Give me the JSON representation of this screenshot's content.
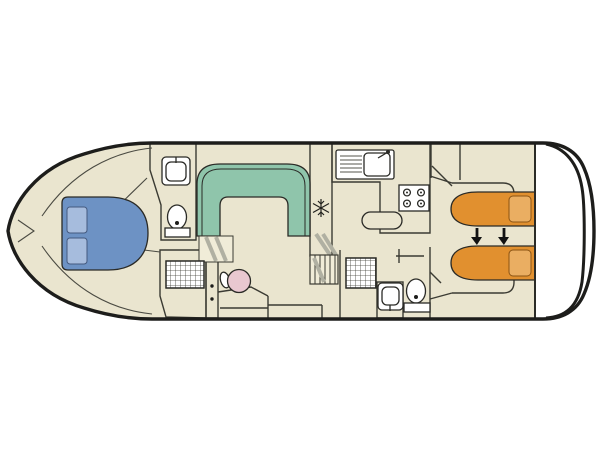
{
  "diagram": {
    "type": "boat-deck-plan",
    "title": "Canal cruiser interior deck plan (no visible text labels)"
  },
  "colors": {
    "background": "#ffffff",
    "hull_stroke": "#1d1d1b",
    "floor_beige": "#eae5cf",
    "room_gray": "#d2d2c4",
    "counter_gray": "#cbcbbd",
    "wall_stroke": "#3b3b33",
    "dinette_green": "#8fc5ab",
    "bed_blue": "#6d92c4",
    "pillow_blue": "#a6bcdd",
    "bed_orange": "#e1902f",
    "pillow_orange": "#eaae62",
    "wheel_pink": "#e9c8d0",
    "fixture_white": "#ffffff",
    "stair_shade": "#b0b0a2",
    "arrow_black": "#121212"
  },
  "rooms": [
    {
      "name": "bow-cabin"
    },
    {
      "name": "bow-bathroom"
    },
    {
      "name": "bow-shower-room"
    },
    {
      "name": "saloon-dinette"
    },
    {
      "name": "helm-station"
    },
    {
      "name": "galley"
    },
    {
      "name": "aft-bathroom"
    },
    {
      "name": "aft-cabin"
    },
    {
      "name": "stern-deck"
    }
  ],
  "fixtures": [
    {
      "name": "bow-double-bed",
      "color_key": "bed_blue",
      "pillows": 2
    },
    {
      "name": "bow-washbasin"
    },
    {
      "name": "bow-toilet"
    },
    {
      "name": "bow-shower"
    },
    {
      "name": "dinette-u-sofa",
      "color_key": "dinette_green"
    },
    {
      "name": "forward-companionway-steps"
    },
    {
      "name": "helm-steering-wheel",
      "color_key": "wheel_pink"
    },
    {
      "name": "helm-seat"
    },
    {
      "name": "fridge-snowflake-icon"
    },
    {
      "name": "galley-sink-with-drainer"
    },
    {
      "name": "galley-stove-4-burner"
    },
    {
      "name": "galley-counter-peninsula"
    },
    {
      "name": "midship-steps"
    },
    {
      "name": "midship-shower"
    },
    {
      "name": "aft-washbasin"
    },
    {
      "name": "aft-toilet"
    },
    {
      "name": "aft-single-bed-top",
      "color_key": "bed_orange",
      "pillows": 1
    },
    {
      "name": "aft-single-bed-bottom",
      "color_key": "bed_orange",
      "pillows": 1
    },
    {
      "name": "bed-conversion-arrows",
      "count": 2
    },
    {
      "name": "wardrobe"
    }
  ]
}
